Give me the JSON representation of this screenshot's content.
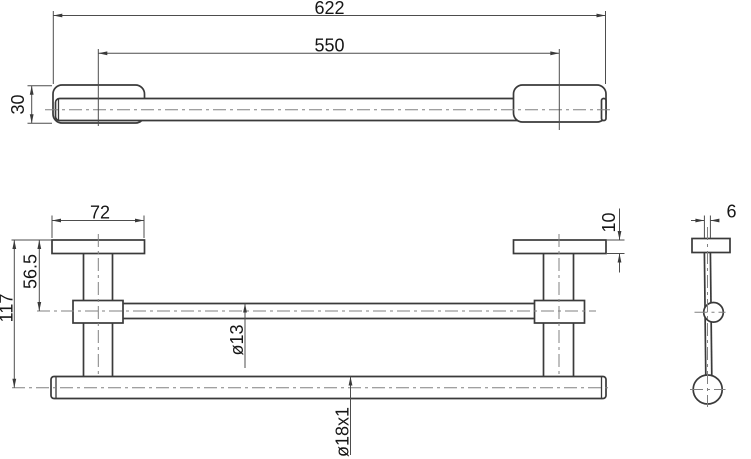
{
  "drawing": {
    "title": "towel-bar-technical-drawing",
    "colors": {
      "background": "#ffffff",
      "outline": "#3a3a3a",
      "dimension_lines": "#4d4d4d",
      "centerlines": "#808080",
      "text": "#161616"
    },
    "dims": {
      "overall_length": "622",
      "mount_spacing": "550",
      "plate_depth": "30",
      "plate_width": "72",
      "plate_thickness": "10",
      "upper_rail_offset": "56.5",
      "overall_height": "117",
      "upper_rail_diameter": "ø13",
      "bar_tube_diameter": "ø18x1",
      "stem_width": "6"
    }
  }
}
